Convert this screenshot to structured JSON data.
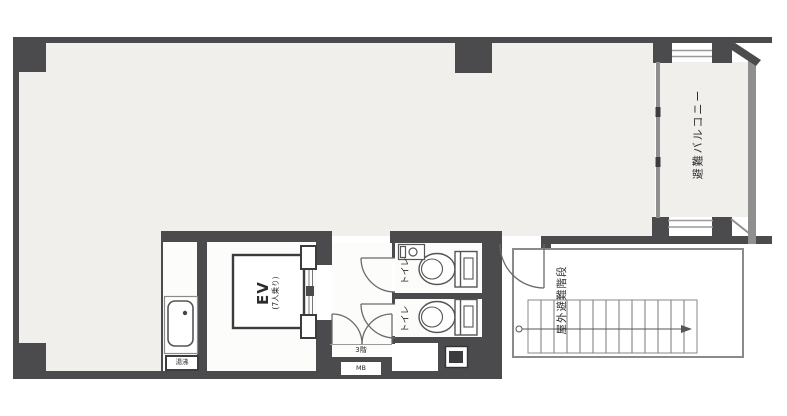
{
  "title": "建物平面図（3階）",
  "labels": {
    "elevator": {
      "line1": "EV",
      "line2": "(7人乗り)"
    },
    "toilet_upper": "トイレ",
    "toilet_lower": "トイレ",
    "balcony": "避難バルコニー",
    "stairs": "屋外避難階段",
    "water_heater": "湯沸",
    "floor": "3階",
    "meter_box": "MB"
  },
  "colors": {
    "wall": "#4b4b4d",
    "wall_light": "#8f8f90",
    "room_fill": "#f0efec",
    "line": "#666666",
    "background": "#ffffff"
  }
}
